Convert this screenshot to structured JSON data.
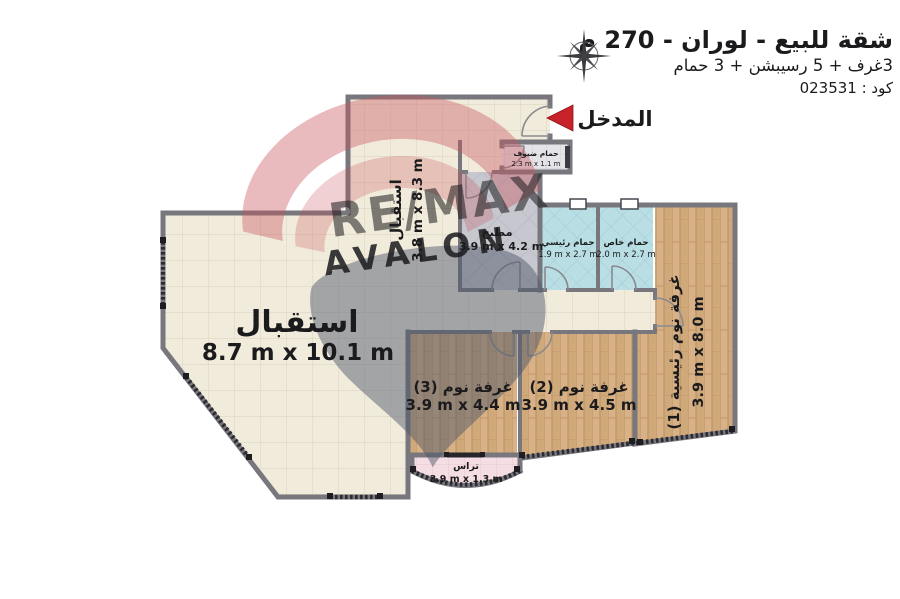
{
  "header": {
    "title": "شقة للبيع - لوران - 270 م",
    "subtitle": "3غرف + 5 رسيبشن + 3 حمام",
    "code": "كود : 023531"
  },
  "entrance": {
    "label": "المدخل"
  },
  "watermark": {
    "line1": "RE/MAX",
    "line2": "AVALON"
  },
  "rooms": [
    {
      "id": "hall",
      "name": "استقبال",
      "dims": "3.8 m x 8.3 m"
    },
    {
      "id": "reception",
      "name": "استقبال",
      "dims": "8.7 m x 10.1 m"
    },
    {
      "id": "kitchen",
      "name": "مطبخ",
      "dims": "3.9 m x 4.2 m"
    },
    {
      "id": "guest-bath",
      "name": "حمام ضيوف",
      "dims": "2.3 m x 1.1 m"
    },
    {
      "id": "master-bath",
      "name": "حمام رئيسي",
      "dims": "1.9 m x 2.7 m"
    },
    {
      "id": "private-bath",
      "name": "حمام خاص",
      "dims": "2.0 m x 2.7 m"
    },
    {
      "id": "master-bedroom",
      "name": "غرفة نوم رئيسية (1)",
      "dims": "3.9 m x 8.0 m"
    },
    {
      "id": "bedroom-2",
      "name": "غرفة نوم (2)",
      "dims": "3.9 m x 4.5 m"
    },
    {
      "id": "bedroom-3",
      "name": "غرفة نوم (3)",
      "dims": "3.9 m x 4.4 m"
    },
    {
      "id": "terrace",
      "name": "تراس",
      "dims": "3.9 m x 1.3 m"
    }
  ],
  "icons": {
    "compass": "compass-rose",
    "entrance_arrow": "left-red-arrow"
  },
  "colors": {
    "accent_red": "#c8232a",
    "wall_gray": "#77777d",
    "floor_cream": "#f1ebdc",
    "floor_kitchen": "#c7c7cf",
    "floor_bath": "#b9dee3",
    "floor_wood": "#d8b286",
    "floor_terrace": "#f5dee3",
    "watermark_red": "#c23a41",
    "watermark_navy": "#4d5569",
    "watermark_sand": "#d8cbb1"
  }
}
